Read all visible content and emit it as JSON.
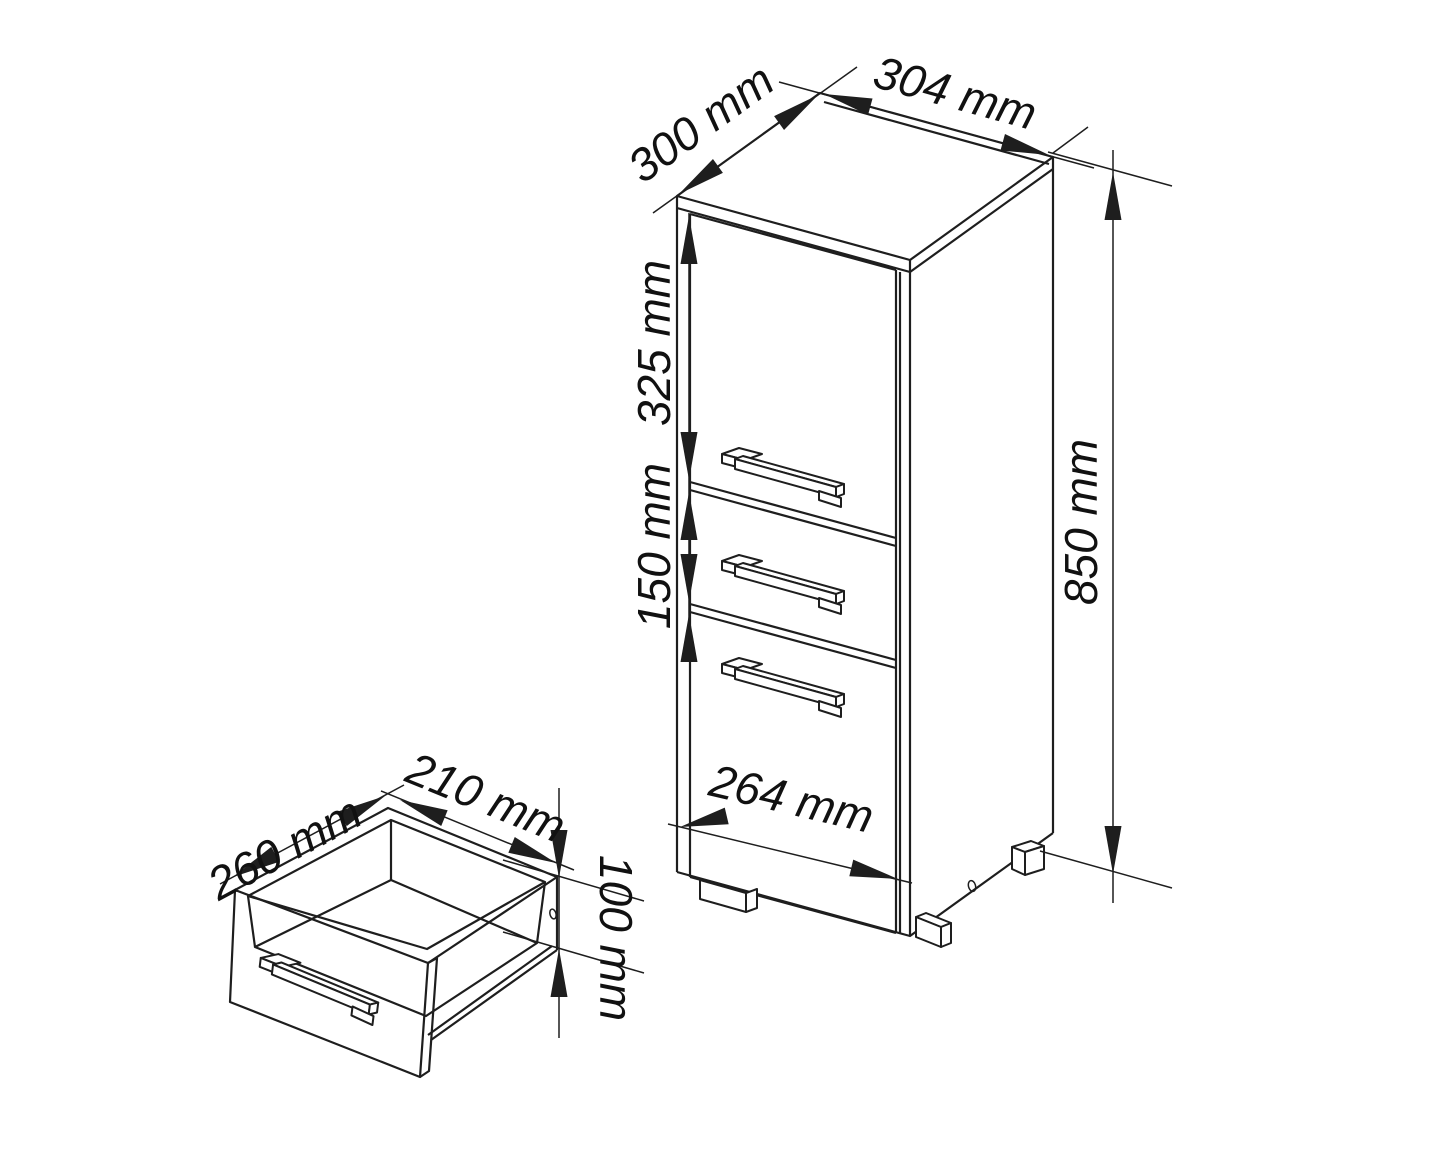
{
  "drawing": {
    "background": "#ffffff",
    "line_color": "#1e1e1e",
    "text_color": "#111111",
    "cabinet": {
      "top_depth": "300 mm",
      "top_width": "304 mm",
      "height": "850 mm",
      "upper_door_height": "325 mm",
      "drawer_front_height": "150 mm",
      "front_width": "264 mm"
    },
    "drawer_detail": {
      "depth": "260 mm",
      "width": "210 mm",
      "side_height": "100 mm"
    }
  }
}
